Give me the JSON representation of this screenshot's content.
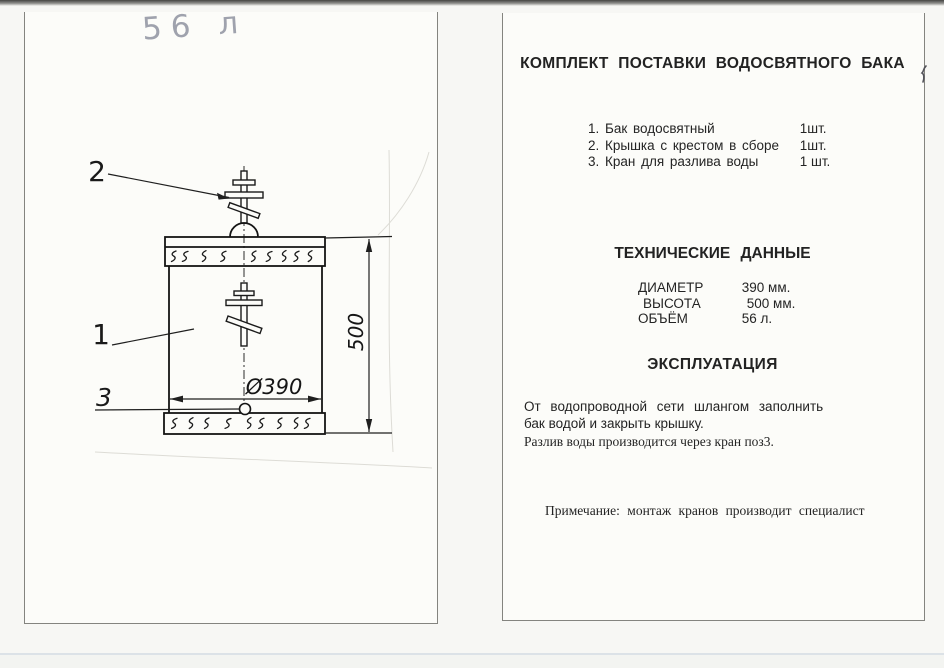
{
  "scan": {
    "paper_color": "#fcfcf9",
    "ink_color": "#1c1c1c",
    "handwriting_color": "#8f93a0"
  },
  "drawing": {
    "handwritten_volume": "56 л",
    "labels": {
      "lid_cross": "2",
      "tank_body": "1",
      "tap": "3"
    },
    "dimensions": {
      "diameter": "Ø390",
      "height": "500"
    }
  },
  "document": {
    "title": "КОМПЛЕКТ ПОСТАВКИ ВОДОСВЯТНОГО БАКА",
    "supply_list": [
      {
        "name": "1. Бак водосвятный",
        "qty": "1шт."
      },
      {
        "name": "2. Крышка с крестом в сборе",
        "qty": "1шт."
      },
      {
        "name": "3. Кран для разлива воды",
        "qty": "1 шт."
      }
    ],
    "technical": {
      "heading": "ТЕХНИЧЕСКИЕ ДАННЫЕ",
      "rows": [
        {
          "label": "ДИАМЕТР",
          "value": "390 мм."
        },
        {
          "label": "ВЫСОТА",
          "value": "500 мм."
        },
        {
          "label": "ОБЪЁМ",
          "value": "56 л."
        }
      ]
    },
    "operation": {
      "heading": "ЭКСПЛУАТАЦИЯ",
      "lines": [
        "От водопроводной сети шлангом заполнить",
        "бак водой и закрыть крышку.",
        "Разлив воды производится через кран поз3."
      ]
    },
    "note": "Примечание: монтаж кранов производит специалист"
  }
}
